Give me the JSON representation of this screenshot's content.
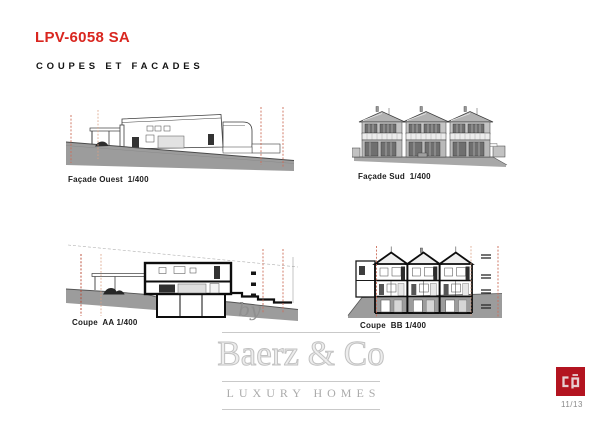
{
  "header": {
    "title": "LPV-6058 SA",
    "subtitle": "COUPES ET FACADES"
  },
  "drawings": [
    {
      "id": "facade-ouest",
      "label": "Façade Ouest  1/400"
    },
    {
      "id": "facade-sud",
      "label": "Façade Sud  1/400"
    },
    {
      "id": "coupe-aa",
      "label": "Coupe  AA 1/400"
    },
    {
      "id": "coupe-bb",
      "label": "Coupe  BB 1/400"
    }
  ],
  "watermark": {
    "prefix": "by",
    "brand": "Baerz & Co",
    "tagline": "LUXURY HOMES"
  },
  "footer": {
    "logo_text": "cp",
    "page_number": "11/13"
  },
  "colors": {
    "accent_red": "#d9261f",
    "boundary_dashed": "#cd6e5a",
    "terrain_gray": "#9c9c9c",
    "logo_red": "#b31420"
  }
}
